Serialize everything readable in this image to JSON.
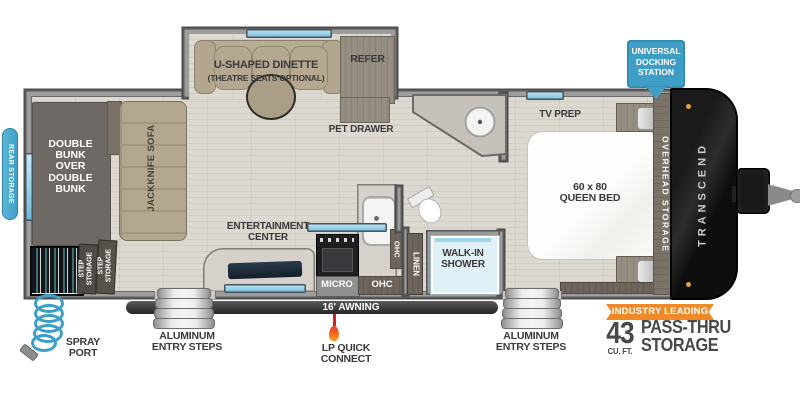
{
  "colors": {
    "badge_blue": "#3f9ec6",
    "accent_orange": "#f08a28",
    "window_blue": "#9fd8ec",
    "awning_dark": "#3c3c3e",
    "text_dark": "#3a393b",
    "wall_gray": "#9d9d9d"
  },
  "plan": {
    "brand": "TRANSCEND",
    "rear_storage": "REAR STORAGE",
    "bunk": "DOUBLE\nBUNK\nOVER\nDOUBLE\nBUNK",
    "step_storage": "STEP\nSTORAGE",
    "sofa": "JACKKNIFE SOFA",
    "dinette_title": "U-SHAPED DINETTE",
    "dinette_sub": "(THEATRE SEATS OPTIONAL)",
    "refer": "REFER",
    "pet_drawer": "PET DRAWER",
    "entertainment": "ENTERTAINMENT\nCENTER",
    "micro": "MICRO",
    "ohc": "OHC",
    "ohc_vertical": "OHC",
    "linen": "LINEN",
    "shower": "WALK-IN\nSHOWER",
    "tv_prep": "TV PREP",
    "queen_bed": "60 x 80\nQUEEN BED",
    "overhead": "OVERHEAD STORAGE"
  },
  "callouts": {
    "docking": "UNIVERSAL\nDOCKING\nSTATION",
    "awning": "16' AWNING",
    "entry_steps": "ALUMINUM\nENTRY STEPS",
    "lp_quick": "LP QUICK\nCONNECT",
    "spray_port": "SPRAY\nPORT",
    "industry": "INDUSTRY LEADING",
    "storage_number": "43",
    "storage_unit": "CU. FT.",
    "storage_text": "PASS-THRU\nSTORAGE"
  }
}
